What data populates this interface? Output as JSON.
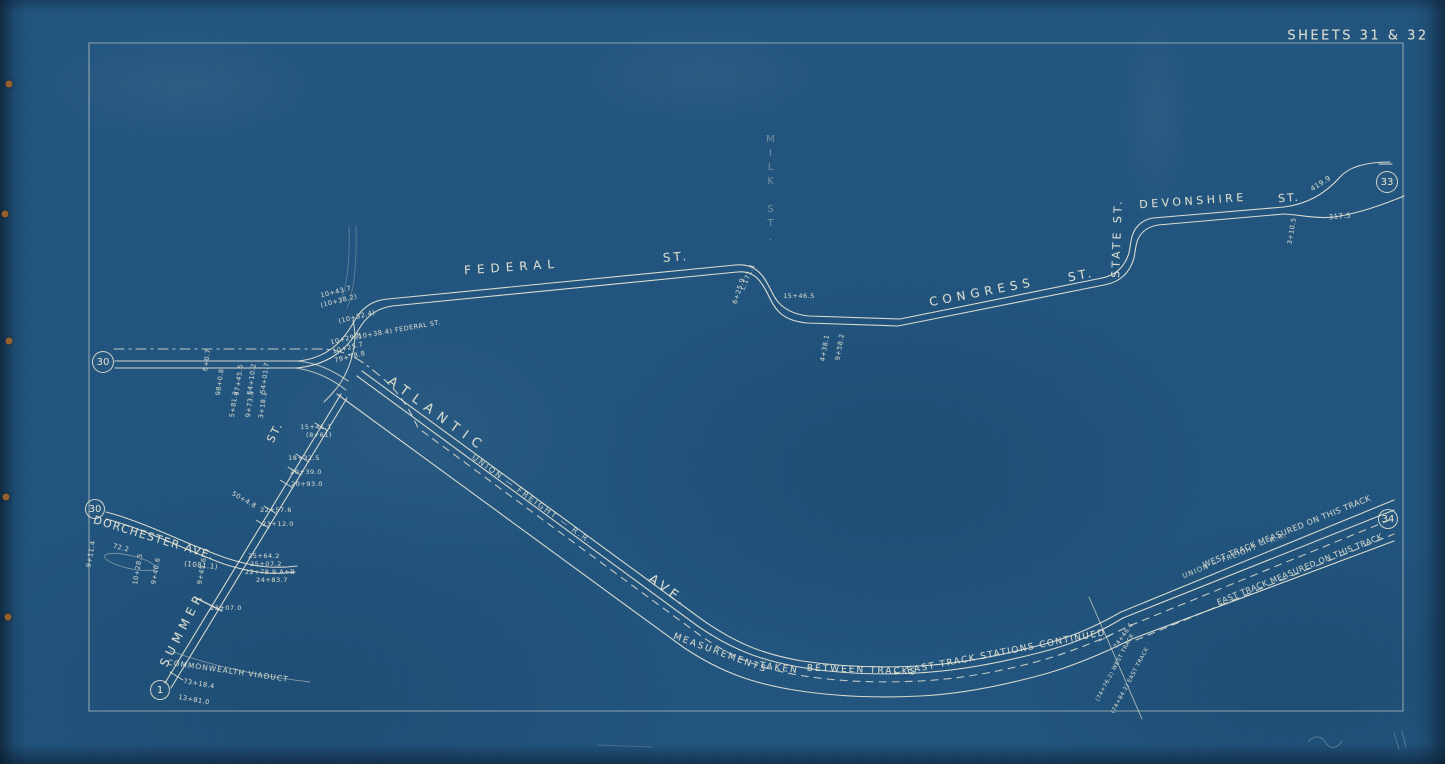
{
  "document": {
    "title": "SHEETS 31 & 32"
  },
  "palette": {
    "paper_blue": "#21547e",
    "paper_edge_dark": "#0d2233",
    "line_ink": "#e9e7d6",
    "rust_dot": "#96602c"
  },
  "connectors": [
    {
      "label": "30",
      "x": 103,
      "y": 362,
      "r": 11
    },
    {
      "label": "30",
      "x": 95,
      "y": 509,
      "r": 10
    },
    {
      "label": "1",
      "x": 160,
      "y": 690,
      "r": 10
    },
    {
      "label": "33",
      "x": 1387,
      "y": 182,
      "r": 11
    },
    {
      "label": "34",
      "x": 1388,
      "y": 519,
      "r": 10
    }
  ],
  "street_labels": [
    {
      "text": "FEDERAL",
      "x": 512,
      "y": 267,
      "rot": -4,
      "fs": 12,
      "ls": 6
    },
    {
      "text": "ST.",
      "x": 676,
      "y": 257,
      "rot": -4,
      "fs": 12,
      "ls": 3
    },
    {
      "text": "CONGRESS",
      "x": 982,
      "y": 292,
      "rot": -11,
      "fs": 12,
      "ls": 5
    },
    {
      "text": "ST.",
      "x": 1081,
      "y": 275,
      "rot": -11,
      "fs": 12,
      "ls": 3
    },
    {
      "text": "STATE ST.",
      "x": 1117,
      "y": 238,
      "rot": -88,
      "fs": 11,
      "ls": 3
    },
    {
      "text": "DEVONSHIRE",
      "x": 1193,
      "y": 201,
      "rot": -4,
      "fs": 11,
      "ls": 3.5
    },
    {
      "text": "ST.",
      "x": 1289,
      "y": 198,
      "rot": -4,
      "fs": 11,
      "ls": 2
    },
    {
      "text": "ATLANTIC",
      "x": 437,
      "y": 415,
      "rot": 36,
      "fs": 13,
      "ls": 7
    },
    {
      "text": "AVE.",
      "x": 668,
      "y": 591,
      "rot": 36,
      "fs": 13,
      "ls": 4
    },
    {
      "text": "UNION — FREIGHT — R.R.",
      "x": 532,
      "y": 500,
      "rot": 36,
      "fs": 8,
      "ls": 2,
      "op": 0.8
    },
    {
      "text": "DORCHESTER AVE.",
      "x": 154,
      "y": 538,
      "rot": 17,
      "fs": 11,
      "ls": 1.5
    },
    {
      "text": "SUMMER",
      "x": 182,
      "y": 629,
      "rot": -63,
      "fs": 12,
      "ls": 5
    },
    {
      "text": "ST.",
      "x": 275,
      "y": 432,
      "rot": -63,
      "fs": 11,
      "ls": 2
    },
    {
      "text": "MILK ST.",
      "x": 770,
      "y": 190,
      "rot": 0,
      "fs": 10,
      "ls": 3,
      "op": 0.38,
      "vert": true
    },
    {
      "text": "COMMONWEALTH VIADUCT",
      "x": 228,
      "y": 671,
      "rot": 8,
      "fs": 7.5,
      "ls": 1,
      "op": 0.85
    },
    {
      "text": "MEASUREMENTS",
      "x": 720,
      "y": 654,
      "rot": 20,
      "fs": 9,
      "ls": 2,
      "op": 0.9
    },
    {
      "text": "TAKEN",
      "x": 779,
      "y": 669,
      "rot": 8,
      "fs": 9,
      "ls": 2,
      "op": 0.9
    },
    {
      "text": "BETWEEN TRACKS",
      "x": 862,
      "y": 671,
      "rot": 2,
      "fs": 9,
      "ls": 2,
      "op": 0.9
    },
    {
      "text": "← EAST TRACK STATIONS CONTINUED",
      "x": 1000,
      "y": 654,
      "rot": -11,
      "fs": 9,
      "ls": 1.5,
      "op": 0.9
    },
    {
      "text": "WEST  TRACK  MEASURED  ON  THIS  TRACK",
      "x": 1287,
      "y": 532,
      "rot": -22,
      "fs": 8,
      "ls": 0.5,
      "op": 0.85
    },
    {
      "text": "UNION — FREIGHT — R.R.",
      "x": 1235,
      "y": 556,
      "rot": -22,
      "fs": 7,
      "ls": 1,
      "op": 0.8
    },
    {
      "text": "EAST  TRACK  MEASURED  ON  THIS  TRACK",
      "x": 1300,
      "y": 570,
      "rot": -22,
      "fs": 8,
      "ls": 0.5,
      "op": 0.85
    }
  ],
  "station_labels": [
    {
      "text": "98+0.8",
      "x": 220,
      "y": 382,
      "rot": -82
    },
    {
      "text": "97+45.6",
      "x": 239,
      "y": 380,
      "rot": -82
    },
    {
      "text": "54+10.2",
      "x": 252,
      "y": 379,
      "rot": -82
    },
    {
      "text": "54+01.7",
      "x": 265,
      "y": 378,
      "rot": -82
    },
    {
      "text": "6+0.7",
      "x": 207,
      "y": 360,
      "rot": -82
    },
    {
      "text": "5+81.2",
      "x": 234,
      "y": 404,
      "rot": -82
    },
    {
      "text": "9+73.5",
      "x": 250,
      "y": 404,
      "rot": -82
    },
    {
      "text": "3+18.1",
      "x": 263,
      "y": 405,
      "rot": -82
    },
    {
      "text": "10+43.7",
      "x": 336,
      "y": 292,
      "rot": -14
    },
    {
      "text": "(10+38.2)",
      "x": 339,
      "y": 301,
      "rot": -14
    },
    {
      "text": "(10+32.4)",
      "x": 357,
      "y": 317,
      "rot": -14
    },
    {
      "text": "(10+38.4) FEDERAL ST.",
      "x": 398,
      "y": 330,
      "rot": -10
    },
    {
      "text": "10+29.8",
      "x": 346,
      "y": 339,
      "rot": -14
    },
    {
      "text": "10+25.7",
      "x": 348,
      "y": 348,
      "rot": -14
    },
    {
      "text": "79+78.8",
      "x": 350,
      "y": 357,
      "rot": -14
    },
    {
      "text": "15+41.1",
      "x": 316,
      "y": 427,
      "rot": 0
    },
    {
      "text": "(8+61)",
      "x": 319,
      "y": 435,
      "rot": 0
    },
    {
      "text": "18+32.5",
      "x": 304,
      "y": 458,
      "rot": 0
    },
    {
      "text": "20+39.0",
      "x": 306,
      "y": 472,
      "rot": 0
    },
    {
      "text": "20+93.0",
      "x": 307,
      "y": 484,
      "rot": 0
    },
    {
      "text": "22+57.6",
      "x": 276,
      "y": 510,
      "rot": 0
    },
    {
      "text": "23+12.0",
      "x": 278,
      "y": 524,
      "rot": 0
    },
    {
      "text": "50+4.8",
      "x": 244,
      "y": 500,
      "rot": 30
    },
    {
      "text": "25+64.2",
      "x": 264,
      "y": 556,
      "rot": 0
    },
    {
      "text": "25+07.2",
      "x": 266,
      "y": 564,
      "rot": 0
    },
    {
      "text": "22+78.9 A+B",
      "x": 270,
      "y": 572,
      "rot": 0
    },
    {
      "text": "24+83.7",
      "x": 272,
      "y": 580,
      "rot": 0
    },
    {
      "text": "23+07.0",
      "x": 226,
      "y": 608,
      "rot": 0
    },
    {
      "text": "73+18.4",
      "x": 199,
      "y": 684,
      "rot": 10
    },
    {
      "text": "13+81.0",
      "x": 194,
      "y": 700,
      "rot": 10
    },
    {
      "text": "72.2",
      "x": 121,
      "y": 548,
      "rot": 14
    },
    {
      "text": "(1081.1)",
      "x": 201,
      "y": 566,
      "rot": 6,
      "fs": 7
    },
    {
      "text": "9+11.4",
      "x": 91,
      "y": 554,
      "rot": -80
    },
    {
      "text": "10+28.5",
      "x": 138,
      "y": 569,
      "rot": -80
    },
    {
      "text": "9+40.6",
      "x": 156,
      "y": 571,
      "rot": -80
    },
    {
      "text": "9+45.6",
      "x": 202,
      "y": 571,
      "rot": -80
    },
    {
      "text": "15+46.5",
      "x": 799,
      "y": 296,
      "rot": 0
    },
    {
      "text": "L.171.1",
      "x": 748,
      "y": 277,
      "rot": -68
    },
    {
      "text": "6+25.9",
      "x": 739,
      "y": 291,
      "rot": -72
    },
    {
      "text": "4+38.1",
      "x": 825,
      "y": 348,
      "rot": -80
    },
    {
      "text": "9+58.2",
      "x": 840,
      "y": 347,
      "rot": -80
    },
    {
      "text": "3+10.5",
      "x": 1292,
      "y": 231,
      "rot": -80
    },
    {
      "text": "419.9",
      "x": 1321,
      "y": 184,
      "rot": -33,
      "fs": 7
    },
    {
      "text": "317.5",
      "x": 1340,
      "y": 217,
      "rot": -5,
      "fs": 7
    },
    {
      "text": "74+46.6",
      "x": 1124,
      "y": 636,
      "rot": -55,
      "fs": 6
    },
    {
      "text": "(74+76.2) WEST TRACK",
      "x": 1116,
      "y": 668,
      "rot": -62,
      "fs": 5.5
    },
    {
      "text": "(74+84.2) EAST TRACK",
      "x": 1131,
      "y": 681,
      "rot": -62,
      "fs": 5.5
    }
  ],
  "binding_holes": [
    {
      "x": 9,
      "y": 84
    },
    {
      "x": 5,
      "y": 214
    },
    {
      "x": 9,
      "y": 341
    },
    {
      "x": 6,
      "y": 497
    },
    {
      "x": 8,
      "y": 617
    }
  ]
}
